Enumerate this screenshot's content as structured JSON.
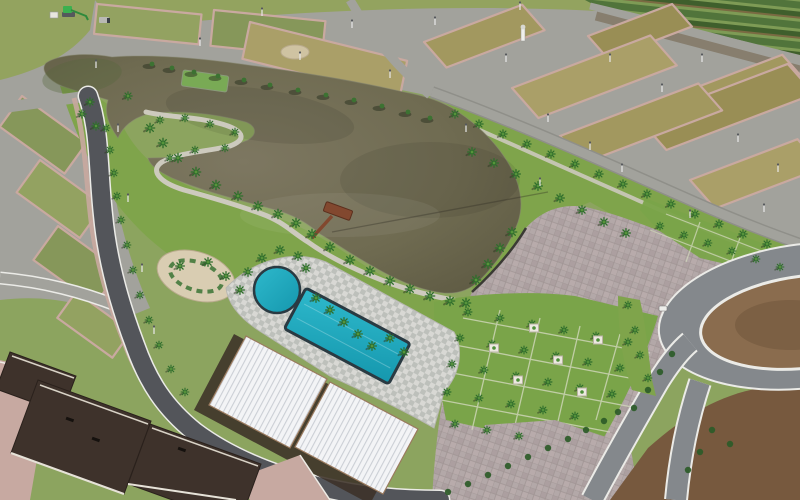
{
  "scene": {
    "semantics": [
      "lake",
      "west-peninsula",
      "green-pond",
      "wooden-pier",
      "lakeside-path",
      "swimming-pool-rectangular",
      "swimming-pool-round",
      "pool-deck",
      "clubhouse-white-roofs",
      "model-houses-brown-roofs",
      "paver-plaza",
      "palm-lawn-southwest",
      "palm-lawn-northeast",
      "land-plots-grid",
      "main-curved-road",
      "plot-roads",
      "roundabout-dirt-circle",
      "farmland-rows",
      "excavator",
      "dump-truck",
      "site-shed",
      "water-tower",
      "street-light-poles"
    ],
    "colors": {
      "grass_base": "#8CA45F",
      "park": "#7FA44B",
      "lawn": "#7AA449",
      "field": "#93A35F",
      "farm_a": "#51743B",
      "farm_b": "#7E9B55",
      "farm_c": "#3F5F2C",
      "farm_brown": "#7A6A42",
      "road_asphalt": "#53555A",
      "road_light": "#A2A29C",
      "road_mid": "#84888C",
      "road_edge": "#EBEBE7",
      "plot_tan": "#A2985F",
      "plot_tan2": "#998E55",
      "plot_tan3": "#AA9F68",
      "plot_green": "#86975A",
      "plot_green2": "#93A261",
      "sidewalk": "#C9A9A0",
      "lake_deep": "#5E5A43",
      "lake_mid": "#6F6B51",
      "lake_light": "#7D7761",
      "lake_green_tint": "#55663D",
      "pond": "#79AA55",
      "plaza": "#B3A8A8",
      "plaza_line": "#A09594",
      "deck_a": "#D8D8D4",
      "deck_b": "#BDC0BB",
      "pool": "#2EB9CC",
      "pool_deep": "#1597AD",
      "pool_edge": "#2A3A42",
      "roof_white": "#F3F4F6",
      "roof_rib": "#CBCFD5",
      "roof_trim": "#9A7A5E",
      "roof_brown": "#3E322B",
      "roof_ridge": "#D8D2C6",
      "pier": "#82482F",
      "dirt": "#8A6C4E",
      "dirt_dark": "#77593E",
      "palm": "#2F6E2C",
      "palm_light": "#57953B",
      "bush": "#2C5B28",
      "shadow": "#2E3A22",
      "planter": "#ECE9E0",
      "paver_yard": "#C7A9A1",
      "machine_green": "#3BB04F",
      "sand_garden": "#D9CDB2",
      "wall_dark": "#3A3A34"
    },
    "plot_axes": {
      "T": [
        0.995,
        0.1,
        -0.1,
        0.995
      ],
      "C": [
        0.97,
        0.24,
        -0.2,
        0.97
      ],
      "L": [
        0.81,
        0.585,
        -0.585,
        0.81
      ],
      "R": [
        0.935,
        -0.355,
        0.66,
        0.75
      ]
    },
    "plots": [
      {
        "g": "T",
        "x": 97,
        "y": 4,
        "w": 105,
        "h": 30,
        "c": "plot_green2"
      },
      {
        "g": "T",
        "x": 214,
        "y": 10,
        "w": 112,
        "h": 36,
        "c": "plot_green"
      },
      {
        "g": "C",
        "x": 250,
        "y": 22,
        "w": 162,
        "h": 38,
        "c": "plot_tan3"
      },
      {
        "g": "L",
        "x": 22,
        "y": 96,
        "w": 80,
        "h": 38,
        "c": "plot_green"
      },
      {
        "g": "L",
        "x": 40,
        "y": 160,
        "w": 78,
        "h": 40,
        "c": "plot_green2"
      },
      {
        "g": "L",
        "x": 58,
        "y": 226,
        "w": 76,
        "h": 42,
        "c": "plot_green"
      },
      {
        "g": "L",
        "x": 76,
        "y": 292,
        "w": 68,
        "h": 32,
        "c": "plot_green2"
      },
      {
        "g": "R",
        "x": 424,
        "y": 42,
        "w": 105,
        "h": 34,
        "c": "plot_tan"
      },
      {
        "g": "R",
        "x": 588,
        "y": 36,
        "w": 90,
        "h": 30,
        "c": "plot_tan2"
      },
      {
        "g": "R",
        "x": 700,
        "y": 86,
        "w": 88,
        "h": 26,
        "c": "plot_tan"
      },
      {
        "g": "R",
        "x": 512,
        "y": 88,
        "w": 148,
        "h": 40,
        "c": "plot_tan3"
      },
      {
        "g": "R",
        "x": 640,
        "y": 120,
        "w": 158,
        "h": 40,
        "c": "plot_tan2"
      },
      {
        "g": "R",
        "x": 560,
        "y": 136,
        "w": 148,
        "h": 36,
        "c": "plot_tan"
      },
      {
        "g": "R",
        "x": 690,
        "y": 180,
        "w": 115,
        "h": 38,
        "c": "plot_tan3"
      }
    ],
    "palm_groups": [
      {
        "name": "shore-southwest",
        "s": 0.85,
        "pts": [
          [
            150,
            128
          ],
          [
            163,
            143
          ],
          [
            178,
            158
          ],
          [
            196,
            172
          ],
          [
            216,
            185
          ],
          [
            238,
            196
          ],
          [
            258,
            206
          ],
          [
            278,
            214
          ],
          [
            296,
            223
          ],
          [
            312,
            234
          ],
          [
            330,
            247
          ],
          [
            350,
            260
          ],
          [
            370,
            271
          ],
          [
            390,
            281
          ],
          [
            410,
            289
          ],
          [
            430,
            296
          ],
          [
            450,
            301
          ],
          [
            466,
            303
          ]
        ]
      },
      {
        "name": "peninsula",
        "s": 0.7,
        "pts": [
          [
            160,
            120
          ],
          [
            185,
            118
          ],
          [
            210,
            124
          ],
          [
            235,
            132
          ],
          [
            225,
            148
          ],
          [
            195,
            150
          ],
          [
            170,
            158
          ]
        ]
      },
      {
        "name": "main-road-edge",
        "s": 0.7,
        "pts": [
          [
            106,
            128
          ],
          [
            110,
            150
          ],
          [
            114,
            173
          ],
          [
            117,
            196
          ],
          [
            121,
            220
          ],
          [
            127,
            245
          ],
          [
            133,
            270
          ],
          [
            140,
            295
          ],
          [
            149,
            320
          ],
          [
            159,
            345
          ],
          [
            171,
            369
          ],
          [
            185,
            392
          ]
        ]
      },
      {
        "name": "west-park",
        "s": 0.75,
        "pts": [
          [
            90,
            102
          ],
          [
            82,
            114
          ],
          [
            96,
            126
          ],
          [
            128,
            96
          ]
        ]
      },
      {
        "name": "northeast-road-row",
        "s": 0.75,
        "pts": [
          [
            455,
            114
          ],
          [
            479,
            124
          ],
          [
            503,
            134
          ],
          [
            527,
            144
          ],
          [
            551,
            154
          ],
          [
            575,
            164
          ],
          [
            599,
            174
          ],
          [
            623,
            184
          ],
          [
            647,
            194
          ],
          [
            671,
            204
          ],
          [
            695,
            214
          ],
          [
            719,
            224
          ],
          [
            743,
            234
          ],
          [
            767,
            244
          ]
        ]
      },
      {
        "name": "northeast-inner-row",
        "s": 0.8,
        "pts": [
          [
            472,
            152
          ],
          [
            494,
            163
          ],
          [
            516,
            174
          ],
          [
            538,
            186
          ],
          [
            560,
            198
          ],
          [
            582,
            210
          ],
          [
            604,
            222
          ],
          [
            626,
            233
          ]
        ]
      },
      {
        "name": "northeast-lawn",
        "s": 0.7,
        "pts": [
          [
            660,
            226
          ],
          [
            684,
            235
          ],
          [
            708,
            243
          ],
          [
            732,
            251
          ],
          [
            756,
            259
          ],
          [
            780,
            267
          ]
        ]
      },
      {
        "name": "plaza-lakeside",
        "s": 0.85,
        "pts": [
          [
            476,
            280
          ],
          [
            488,
            264
          ],
          [
            500,
            248
          ],
          [
            512,
            232
          ]
        ]
      },
      {
        "name": "southwest-lawn-grid",
        "s": 0.72,
        "pts": [
          [
            468,
            312
          ],
          [
            500,
            318
          ],
          [
            532,
            324
          ],
          [
            564,
            330
          ],
          [
            596,
            336
          ],
          [
            628,
            342
          ],
          [
            460,
            338
          ],
          [
            492,
            344
          ],
          [
            524,
            350
          ],
          [
            556,
            356
          ],
          [
            588,
            362
          ],
          [
            620,
            368
          ],
          [
            452,
            364
          ],
          [
            484,
            370
          ],
          [
            516,
            376
          ],
          [
            548,
            382
          ],
          [
            580,
            388
          ],
          [
            612,
            394
          ],
          [
            447,
            392
          ],
          [
            479,
            398
          ],
          [
            511,
            404
          ],
          [
            543,
            410
          ],
          [
            575,
            416
          ],
          [
            455,
            424
          ],
          [
            487,
            430
          ],
          [
            519,
            436
          ]
        ]
      },
      {
        "name": "pool-garden",
        "s": 0.8,
        "pts": [
          [
            248,
            272
          ],
          [
            262,
            258
          ],
          [
            280,
            250
          ],
          [
            298,
            256
          ],
          [
            306,
            268
          ],
          [
            316,
            298
          ],
          [
            330,
            310
          ],
          [
            344,
            322
          ],
          [
            358,
            334
          ],
          [
            372,
            346
          ],
          [
            390,
            338
          ],
          [
            404,
            352
          ],
          [
            240,
            290
          ],
          [
            180,
            266
          ],
          [
            208,
            262
          ],
          [
            226,
            276
          ]
        ]
      },
      {
        "name": "roundabout-west",
        "s": 0.7,
        "pts": [
          [
            628,
            305
          ],
          [
            635,
            330
          ],
          [
            640,
            355
          ],
          [
            648,
            378
          ]
        ]
      }
    ],
    "bushes": [
      [
        448,
        492
      ],
      [
        468,
        484
      ],
      [
        488,
        475
      ],
      [
        508,
        466
      ],
      [
        528,
        457
      ],
      [
        548,
        448
      ],
      [
        568,
        439
      ],
      [
        586,
        430
      ],
      [
        604,
        421
      ],
      [
        618,
        412
      ],
      [
        634,
        408
      ],
      [
        648,
        390
      ],
      [
        660,
        372
      ],
      [
        672,
        354
      ],
      [
        700,
        452
      ],
      [
        688,
        470
      ],
      [
        712,
        430
      ],
      [
        730,
        444
      ]
    ],
    "shade_trees": [
      [
        152,
        64
      ],
      [
        172,
        68
      ],
      [
        194,
        72
      ],
      [
        218,
        76
      ],
      [
        244,
        80
      ],
      [
        270,
        85
      ],
      [
        298,
        90
      ],
      [
        326,
        95
      ],
      [
        354,
        100
      ],
      [
        382,
        106
      ],
      [
        408,
        112
      ],
      [
        430,
        118
      ]
    ],
    "planters": [
      [
        534,
        328
      ],
      [
        598,
        340
      ],
      [
        494,
        348
      ],
      [
        558,
        360
      ],
      [
        518,
        380
      ],
      [
        582,
        392
      ]
    ],
    "poles": [
      [
        435,
        25
      ],
      [
        520,
        10
      ],
      [
        610,
        62
      ],
      [
        548,
        122
      ],
      [
        662,
        92
      ],
      [
        702,
        62
      ],
      [
        738,
        142
      ],
      [
        778,
        172
      ],
      [
        622,
        172
      ],
      [
        506,
        62
      ],
      [
        466,
        132
      ],
      [
        690,
        218
      ],
      [
        764,
        212
      ],
      [
        118,
        132
      ],
      [
        128,
        202
      ],
      [
        142,
        272
      ],
      [
        154,
        334
      ],
      [
        96,
        68
      ],
      [
        200,
        46
      ],
      [
        300,
        60
      ],
      [
        390,
        78
      ],
      [
        352,
        28
      ],
      [
        262,
        16
      ],
      [
        540,
        186
      ],
      [
        590,
        150
      ]
    ]
  }
}
